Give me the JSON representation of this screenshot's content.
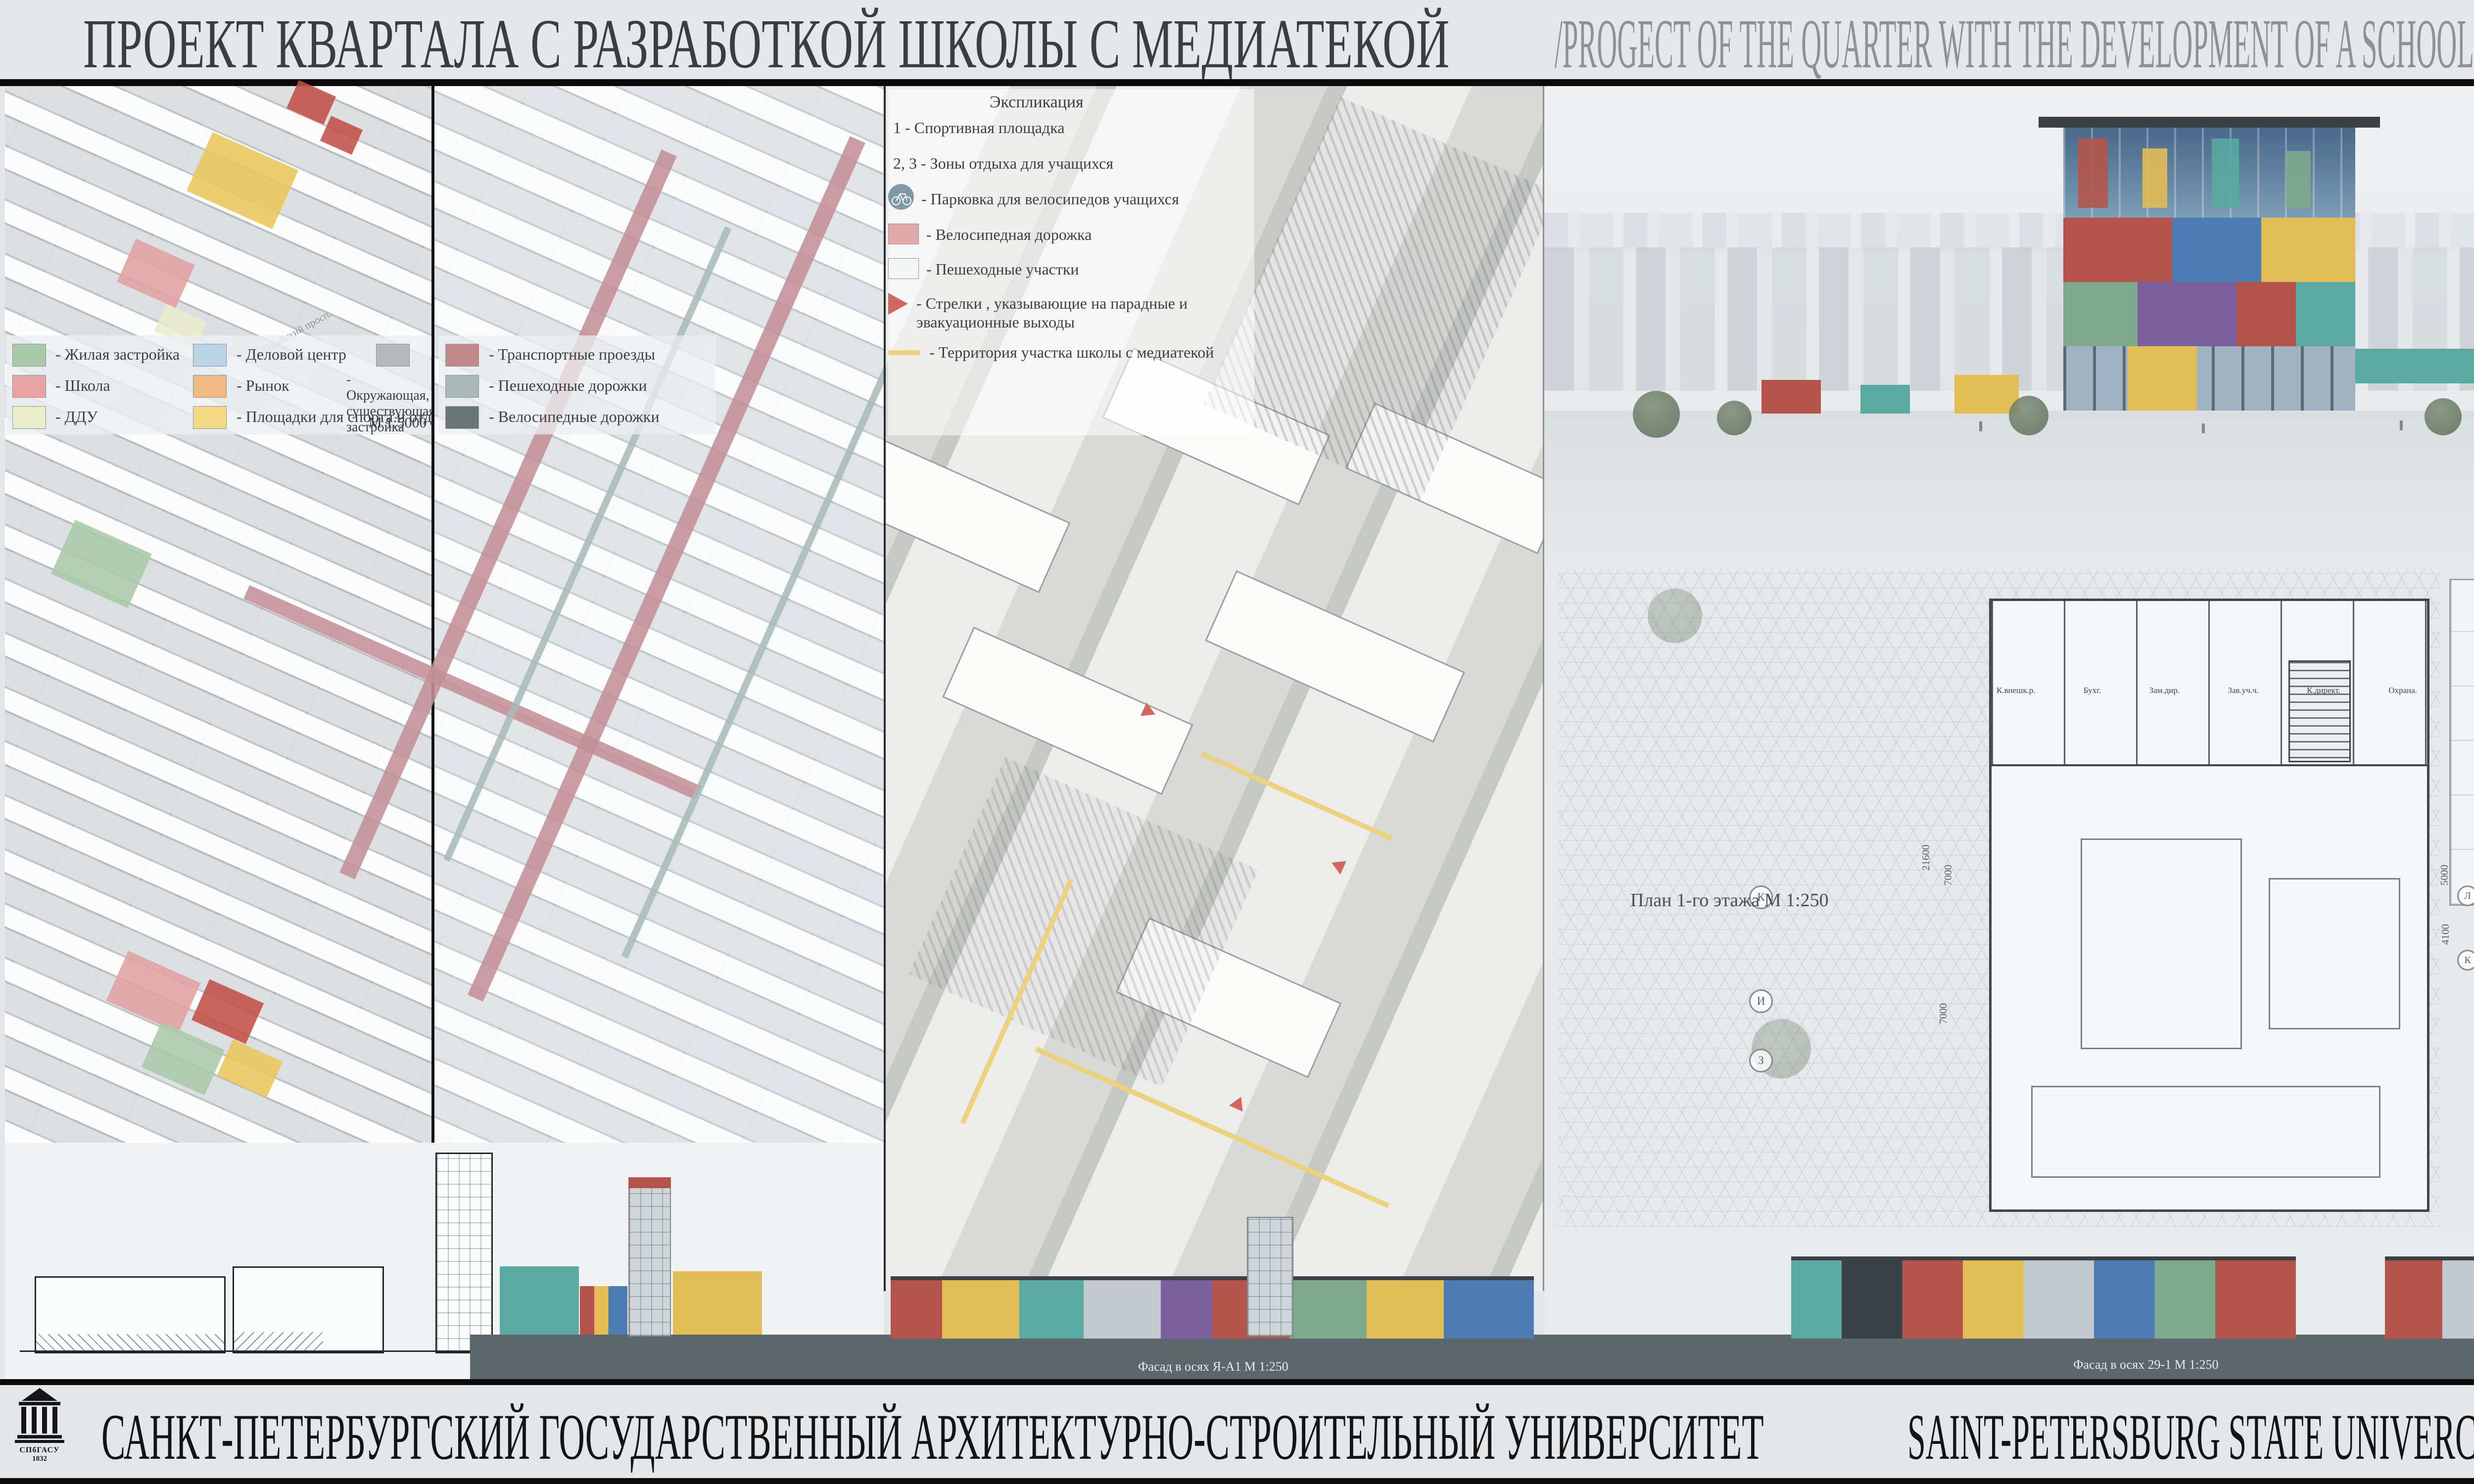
{
  "header": {
    "title_ru": "ПРОЕКТ КВАРТАЛА С РАЗРАБОТКОЙ ШКОЛЫ С МЕДИАТЕКОЙ ",
    "title_en": "/PROGECT OF THE QUARTER WITH THE DEVELOPMENT OF A SCHOOL WITH A MEDIA LIBRARY",
    "corner_letter": "Б",
    "corner_color": "#0d55a4"
  },
  "map1": {
    "scale": "М 1:5000",
    "road_label": "Дунайский просп.",
    "legend": [
      {
        "label": "- Жилая застройка",
        "color": "#a9c9a9"
      },
      {
        "label": "- Школа",
        "color": "#e8a3a3"
      },
      {
        "label": "- ДДУ",
        "color": "#e9edc9"
      },
      {
        "label": "- Деловой центр",
        "color": "#b9d5e5"
      },
      {
        "label": "- Рынок",
        "color": "#f1b985"
      },
      {
        "label": "- Площадки для спорта и отдыха",
        "color": "#f5d985"
      },
      {
        "label": "- Окружающая, существующая застройка",
        "color": "#b5b9bd"
      }
    ]
  },
  "map2": {
    "legend": [
      {
        "label": "- Транспортные проезды",
        "color": "#c18989"
      },
      {
        "label": "- Пешеходные дорожки",
        "color": "#a9b9b9"
      },
      {
        "label": "- Велосипедные дорожки",
        "color": "#6b7579"
      }
    ]
  },
  "map3": {
    "title": "Экспликация",
    "items": [
      "1 - Спортивная площадка",
      "2, 3 - Зоны отдыха для учащихся",
      "- Парковка для велосипедов учащихся",
      "- Велосипедная дорожка",
      "- Пешеходные участки",
      "- Стрелки , указывающие на парадные и эвакуационные выходы",
      "- Территория участка школы с медиатекой"
    ]
  },
  "plans": {
    "plan1": {
      "label": "План 1-го этажа  М 1:250",
      "rooms": [
        "К.внешк.р.",
        "Бухг.",
        "Зам.дир.",
        "Зав.уч.ч.",
        "К.директ.",
        "Охрана."
      ],
      "grid_letters": [
        "К",
        "И",
        "З"
      ],
      "dims": [
        "21600",
        "7000",
        "7000"
      ]
    },
    "plan2": {
      "label": "План 2-го этажа  М 1:400",
      "grid_numbers": [
        "9",
        "10",
        "11",
        "12",
        "14"
      ],
      "grid_letters": [
        "Л",
        "К",
        "Д",
        "В",
        "Е1"
      ],
      "dims": [
        "5000",
        "4100",
        "10600"
      ]
    },
    "plan3": {
      "label": "План 3-го этажа  М 1:400",
      "grid_letters": [
        "Б",
        "А",
        "Е1"
      ],
      "dims": [
        "6000",
        "10600"
      ]
    },
    "lower": {
      "labels": [
        "План 4-го этажа  М 1:400",
        "План 5-го этажа  М 1:400",
        "План 6-го этажа  М 1:400"
      ],
      "bubbles": [
        "1а",
        "2а",
        "3а",
        "4а",
        "17",
        "5а"
      ],
      "dims": [
        "8300",
        "8300",
        "15000",
        "24000",
        "18000",
        "73600"
      ]
    }
  },
  "details": {
    "dims": [
      "30000",
      "45100"
    ],
    "marks": [
      "0.00",
      "-0.60"
    ]
  },
  "elevations": {
    "labels": [
      "Фасад в осях  Я-А1  М 1:250",
      "Фасад в осях  29-1  М 1:250",
      "Фасад в осях  1-29  М 1:250",
      "Визуализация"
    ]
  },
  "info": {
    "project_by": "ПРОЕКТ\nВЫПОЛНИЛА:",
    "author": [
      {
        "ru": "УВАРОВА",
        "en": "UVAROVA"
      },
      {
        "ru": "ЕКАТЕРИНА",
        "en": "YEKATERINA"
      },
      {
        "ru": "НИКОЛАЕВНА",
        "en": "NIKOLAEVNA"
      }
    ],
    "phone_label": "тел.",
    "phone": "+79218891042",
    "email_label": "email",
    "email": "kate2596@mail.ru",
    "professors_label": "ФИО Руководителей /  PROFESSORS",
    "professors": [
      {
        "ru": "ПРОФЕССОР    О.С. РОМАНОВ",
        "en": "PROFESSOR    O.S. ROMANOV"
      },
      {
        "ru": "ПРОФЕССОР    Ю.И.  КУРБАТОВ",
        "en": "PROFESSOR    Y.I.  KURBATOV"
      },
      {
        "ru": "ДОЦЕНТ    И.Н.  ДЕМЕНОВ",
        "en": "ASSISTENT PROFESSOR    I.N. DEMINOV"
      },
      {
        "ru": "ДОЦЕНТ    Е.Г.  ВОЙЦЕХОВСКАЯ",
        "en": "ASSISTENT PROFESSOR    E.G. WOYTSEKHOVSKAYA"
      }
    ],
    "annotation_title": "АННОТАЦИЯ К ПРОЕКТУ:",
    "annotation_ru": "Основной целью при проектировании квартала было создание комфортной жилой среды путем определения четких границ общегородской и дворовой территории, созданием многофункциональных общественных пространств, обеспечением подземного паркинга, что позволило сделать дворы полностью пешеходными, высокой степенью озеленения, оснащением велодорожками и высотностью жилой застройки в 6-7 этажей.\nПланировочное решение задает главная ось, формирующая жилую застройку Площадь организована таким образом, что имеет связь со всеми функциональными зонами квартала.\nОбъемно-планировочная концепция школы - ступенчатая структура, которая была сформирована под влиянием особенностей отведенной территории. Каждая функциональная зона школы как в плане, так и в перспективе выражается отдельным объемом и особым цветовым решением на фасадах, которое отсылает к суприматизму. Запроектированая большая вестибюльная зона с амфитеатром и оранжереей, своего рода площадь,которая обеспечивает доступ к каждой функциональной зоне. В плане нет типычных для школ коридоров, вместо них перетикающие друг в друга рекреационные пространства.\nЧерез второй этаж проходит пешеходный мост в медиатеку. Здание медиатеки обращено главным фасадом на центральную площадь квартала, и выполняет роль доминанты и местом притяжения всего квартала.\nВнутренняя структура здания сформирована из динамичных объёмов разных цветов и размеров, образующих сложные перетикающие друг в друга пространства,которые накрывает стеклянная оболочка простой прямоугольной формы.",
    "annotation_en": "The main purpose of the design of the quarter was to create a comfortable living enviroment by defining clear boundaries of the city and yard area, creating many public spaces, providing undeground parking , witch allowed to make the yard completely pedestrian, hight degree of gardening, aquipping bike paths.The area is organized in such a way, that has a connection with all functional zones of the quarter.\nSpace-planning concept school is a step-by-step structure that was formed under the influence of features of the allotted territory. Each functional area of the school as in the plan, and in the perspective is expressed in a separate volume and special color. solution on the facades, which sendsto suprematism. Projected large entrance hall with amphitheater and greenspace, some kind of square, that provides access to each functional area. In the plan there are no typical school corridors , instead of them transitional to each other recreational spaces. Through the second floor there is a pedestrian bridge to the media library The building of the media library is located on the central square of the quarter, and serves as a dominant. The internal structure of the building is formed from dynamic volumes of different colors and dimensions that form complex perekasayuschie each other space.\nwhich covers the glass shape."
  },
  "footer": {
    "logo_acronym": "СПбГАСУ",
    "logo_year": "1832",
    "university_ru": "САНКТ-ПЕТЕРБУРГСКИЙ ГОСУДАРСТВЕННЫЙ АРХИТЕКТУРНО-СТРОИТЕЛЬНЫЙ УНИВЕРСИТЕТ",
    "university_en": "SAINT-PETERSBURG STATE UNIVERCITY OF ARCHITECTURE AND CIVIL ENGINEERING"
  },
  "palette": {
    "board_bg": "#e3e7ea",
    "title_dark": "#3b3e40",
    "title_gray": "#8d9296",
    "ground_band": "#5d676b",
    "facade_red": "#b5544c",
    "facade_blue": "#4d7cb4",
    "facade_yellow": "#e3bd55",
    "facade_green": "#7fa98c",
    "facade_purple": "#7b5f9e",
    "facade_teal": "#58aaa2"
  }
}
